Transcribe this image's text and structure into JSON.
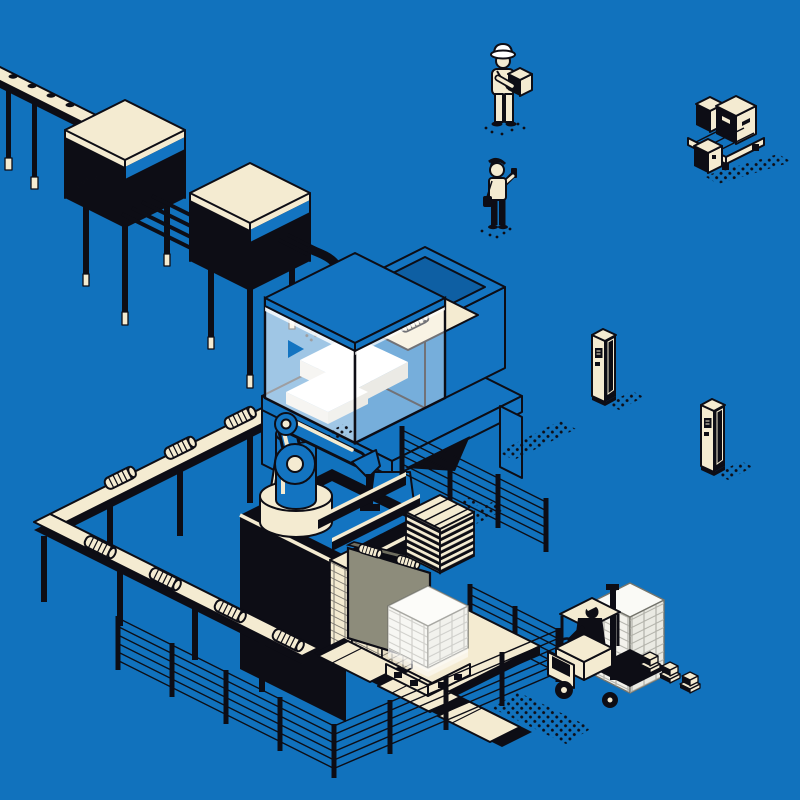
{
  "scene": {
    "title": "Isometric smart factory automation illustration on blue background",
    "elements": [
      {
        "id": "infeed-conveyor",
        "label": "Perforated in-feed conveyor on legs"
      },
      {
        "id": "process-machine-1",
        "label": "Processing machine with cream lid"
      },
      {
        "id": "process-machine-2",
        "label": "Second processing machine with cream lid"
      },
      {
        "id": "transfer-rails",
        "label": "Rail link between machines"
      },
      {
        "id": "feed-pipe",
        "label": "Curved feed pipe into assembly cell"
      },
      {
        "id": "enclosed-machine",
        "label": "Glass-enclosed assembly machine on blue stand"
      },
      {
        "id": "output-tray",
        "label": "Tray with ribbed cylinder part"
      },
      {
        "id": "elevated-conveyor",
        "label": "Elevated conveyor carrying cylinder parts"
      },
      {
        "id": "robot-arm",
        "label": "Industrial robot arm on black platform"
      },
      {
        "id": "steel-beams",
        "label": "Black profiles handled by robot"
      },
      {
        "id": "carton-stacks",
        "label": "Stacked cartons beside robot"
      },
      {
        "id": "roller-panel",
        "label": "Olive panel with rollers"
      },
      {
        "id": "empty-pallet-stack",
        "label": "Stack of empty wooden pallets"
      },
      {
        "id": "floor-conveyor",
        "label": "Floor plate conveyor"
      },
      {
        "id": "wrapped-pallet",
        "label": "Shrink-wrapped pallet load"
      },
      {
        "id": "safety-fence",
        "label": "Wire safety fencing with posts"
      },
      {
        "id": "forklift",
        "label": "Forklift with driver moving tall pallet load"
      },
      {
        "id": "mini-pallet-row",
        "label": "Row of small pallet boxes"
      },
      {
        "id": "storage-pallet",
        "label": "Pallet with shipping boxes"
      },
      {
        "id": "kiosk-1",
        "label": "Control kiosk pillar"
      },
      {
        "id": "kiosk-2",
        "label": "Control kiosk pillar"
      },
      {
        "id": "worker-carrying-box",
        "label": "Worker in hard hat carrying box"
      },
      {
        "id": "supervisor-with-phone",
        "label": "Supervisor checking phone"
      }
    ]
  },
  "palette": {
    "bg": "#1172BD",
    "ink": "#0D0D15",
    "cream": "#F4EBD1",
    "blue": "#1374C1",
    "blue2": "#0E5FA3",
    "white": "#FFFFFF",
    "olive": "#8D8C7B",
    "boxfill": "#F3F2EC",
    "boxline": "#74746C"
  }
}
